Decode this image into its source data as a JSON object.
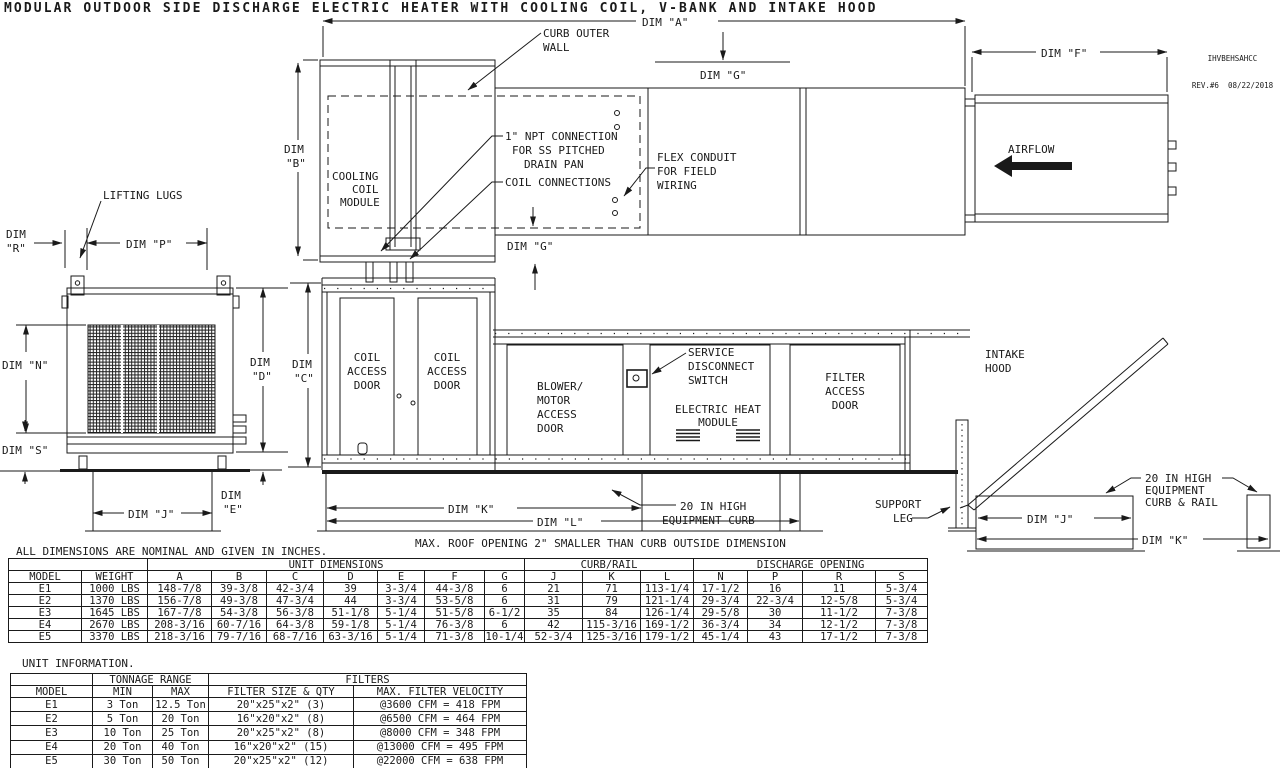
{
  "title": "MODULAR OUTDOOR SIDE DISCHARGE ELECTRIC HEATER WITH COOLING COIL, V-BANK AND INTAKE HOOD",
  "doc": {
    "number": "IHVBEHSAHCC",
    "revision": "REV.#6  08/22/2018"
  },
  "dims": {
    "a": "DIM \"A\"",
    "f": "DIM \"F\"",
    "g_top": "DIM \"G\"",
    "g_bottom": "DIM \"G\"",
    "b1": "DIM",
    "b2": "\"B\"",
    "c1": "DIM",
    "c2": "\"C\"",
    "d1": "DIM",
    "d2": "\"D\"",
    "e1": "DIM",
    "e2": "\"E\"",
    "r1": "DIM",
    "r2": "\"R\"",
    "n": "DIM \"N\"",
    "p": "DIM \"P\"",
    "s": "DIM \"S\"",
    "j_side": "DIM \"J\"",
    "k_curb": "DIM \"K\"",
    "l_curb": "DIM \"L\"",
    "j_rail": "DIM \"J\"",
    "k_rail": "DIM \"K\""
  },
  "callouts": {
    "curb_outer_wall": [
      "CURB OUTER",
      "WALL"
    ],
    "npt_connection": [
      "1\" NPT CONNECTION",
      "FOR SS PITCHED",
      "DRAIN PAN"
    ],
    "coil_connections": "COIL CONNECTIONS",
    "flex_conduit": [
      "FLEX CONDUIT",
      "FOR FIELD",
      "WIRING"
    ],
    "airflow": "AIRFLOW",
    "lifting_lugs": "LIFTING LUGS",
    "cooling_coil_module": [
      "COOLING",
      "COIL",
      "MODULE"
    ],
    "coil_access_door": [
      "COIL",
      "ACCESS",
      "DOOR"
    ],
    "blower_motor_access_door": [
      "BLOWER/",
      "MOTOR",
      "ACCESS",
      "DOOR"
    ],
    "service_disconnect_switch": [
      "SERVICE",
      "DISCONNECT",
      "SWITCH"
    ],
    "electric_heat_module": [
      "ELECTRIC HEAT",
      "MODULE"
    ],
    "filter_access_door": [
      "FILTER",
      "ACCESS",
      "DOOR"
    ],
    "intake_hood": [
      "INTAKE",
      "HOOD"
    ],
    "equipment_curb": [
      "20 IN HIGH",
      "EQUIPMENT CURB"
    ],
    "support_leg": [
      "SUPPORT",
      "LEG"
    ],
    "max_roof_opening": "MAX. ROOF OPENING 2\" SMALLER THAN CURB OUTSIDE DIMENSION",
    "curb_rail_label": [
      "20 IN HIGH",
      "EQUIPMENT",
      "CURB & RAIL"
    ],
    "curb_rail_caption": [
      "CURB/RAIL COMBINATION",
      "USED IN PLACE OF",
      "SINGLE CURB ON SIZE",
      "4 AND 5 UNITS"
    ]
  },
  "dim_table": {
    "note": "ALL DIMENSIONS ARE NOMINAL AND GIVEN IN INCHES.",
    "group_headers": {
      "unit_dimensions": "UNIT DIMENSIONS",
      "curb_rail": "CURB/RAIL",
      "discharge_opening": "DISCHARGE OPENING"
    },
    "columns": [
      "MODEL",
      "WEIGHT",
      "A",
      "B",
      "C",
      "D",
      "E",
      "F",
      "G",
      "J",
      "K",
      "L",
      "N",
      "P",
      "R",
      "S"
    ],
    "rows": [
      [
        "E1",
        "1000 LBS",
        "148-7/8",
        "39-3/8",
        "42-3/4",
        "39",
        "3-3/4",
        "44-3/8",
        "6",
        "21",
        "71",
        "113-1/4",
        "17-1/2",
        "16",
        "11",
        "5-3/4"
      ],
      [
        "E2",
        "1370 LBS",
        "156-7/8",
        "49-3/8",
        "47-3/4",
        "44",
        "3-3/4",
        "53-5/8",
        "6",
        "31",
        "79",
        "121-1/4",
        "29-3/4",
        "22-3/4",
        "12-5/8",
        "5-3/4"
      ],
      [
        "E3",
        "1645 LBS",
        "167-7/8",
        "54-3/8",
        "56-3/8",
        "51-1/8",
        "5-1/4",
        "51-5/8",
        "6-1/2",
        "35",
        "84",
        "126-1/4",
        "29-5/8",
        "30",
        "11-1/2",
        "7-3/8"
      ],
      [
        "E4",
        "2670 LBS",
        "208-3/16",
        "60-7/16",
        "64-3/8",
        "59-1/8",
        "5-1/4",
        "76-3/8",
        "6",
        "42",
        "115-3/16",
        "169-1/2",
        "36-3/4",
        "34",
        "12-1/2",
        "7-3/8"
      ],
      [
        "E5",
        "3370 LBS",
        "218-3/16",
        "79-7/16",
        "68-7/16",
        "63-3/16",
        "5-1/4",
        "71-3/8",
        "10-1/4",
        "52-3/4",
        "125-3/16",
        "179-1/2",
        "45-1/4",
        "43",
        "17-1/2",
        "7-3/8"
      ]
    ]
  },
  "unit_table": {
    "note": "UNIT INFORMATION.",
    "group_headers": {
      "tonnage_range": "TONNAGE RANGE",
      "filters": "FILTERS"
    },
    "columns": [
      "MODEL",
      "MIN",
      "MAX",
      "FILTER SIZE & QTY",
      "MAX. FILTER VELOCITY"
    ],
    "rows": [
      [
        "E1",
        "3 Ton",
        "12.5 Ton",
        "20\"x25\"x2\" (3)",
        "@3600 CFM = 418 FPM"
      ],
      [
        "E2",
        "5 Ton",
        "20 Ton",
        "16\"x20\"x2\" (8)",
        "@6500 CFM = 464 FPM"
      ],
      [
        "E3",
        "10 Ton",
        "25 Ton",
        "20\"x25\"x2\" (8)",
        "@8000 CFM = 348 FPM"
      ],
      [
        "E4",
        "20 Ton",
        "40 Ton",
        "16\"x20\"x2\" (15)",
        "@13000 CFM = 495 FPM"
      ],
      [
        "E5",
        "30 Ton",
        "50 Ton",
        "20\"x25\"x2\" (12)",
        "@22000 CFM = 638 FPM"
      ]
    ]
  }
}
